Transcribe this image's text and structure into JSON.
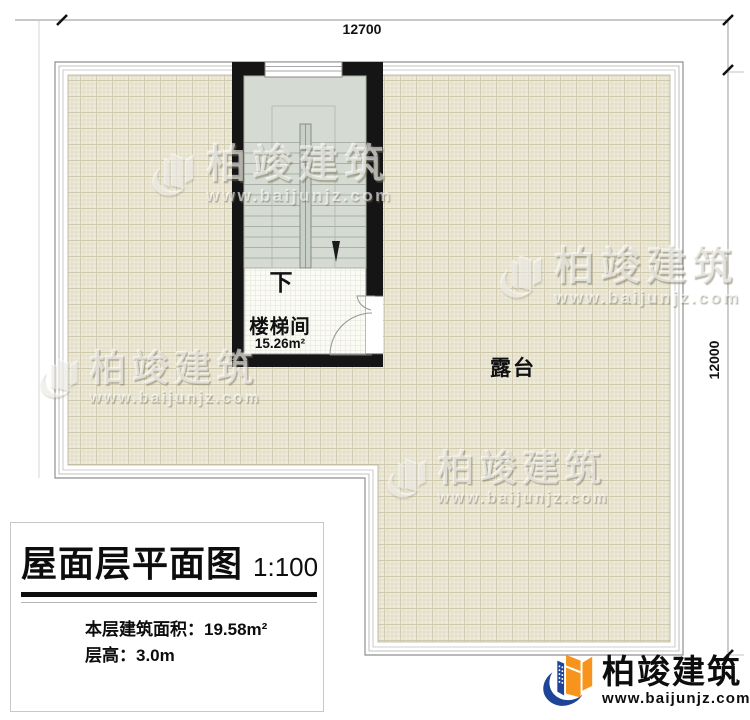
{
  "plan": {
    "dimensions": {
      "top": "12700",
      "right": "12000"
    },
    "stairwell": {
      "name": "楼梯间",
      "area": "15.26m²",
      "direction": "下"
    },
    "terrace": {
      "name": "露台"
    }
  },
  "title_block": {
    "title": "屋面层平面图",
    "scale": "1:100",
    "area_label": "本层建筑面积：",
    "area_value": "19.58m²",
    "floor_height_label": "层高：",
    "floor_height_value": "3.0m"
  },
  "watermark": {
    "brand": "柏竣建筑",
    "url": "www.baijunjz.com"
  },
  "branding": {
    "brand": "柏竣建筑",
    "url": "www.baijunjz.com"
  },
  "colors": {
    "wall": "#151515",
    "terrace_fill": "#edeada",
    "stair_fill": "#d5dbd2",
    "brand_orange": "#f7941d",
    "brand_blue": "#1d4496"
  }
}
